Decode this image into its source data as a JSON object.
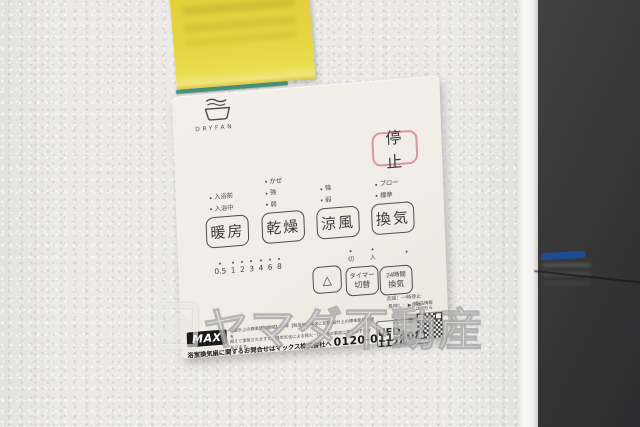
{
  "scene": {
    "watermark": {
      "text": "ヤマダ不動産"
    }
  },
  "colors": {
    "sticky_note_yellow": "#e7d33e",
    "note_strip_teal": "#3f9f85",
    "panel_bg": "#f1eee7",
    "stop_accent_pink": "#dd93a2",
    "button_line": "#4d4d50",
    "dark_door": "#353535",
    "door_sticker_blue": "#1c4f9c",
    "max_logo_bg": "#1a1a1a"
  },
  "panel": {
    "brand": {
      "name": "DRYFAN"
    },
    "stop_button": {
      "label": "停止"
    },
    "modes": [
      {
        "label": "暖房",
        "indicators": [
          "入浴前",
          "入浴中"
        ]
      },
      {
        "label": "乾燥",
        "indicators": [
          "かぜ",
          "強",
          "弱"
        ]
      },
      {
        "label": "涼風",
        "indicators": [
          "強",
          "弱"
        ]
      },
      {
        "label": "換気",
        "indicators": [
          "ブロー",
          "標準"
        ]
      }
    ],
    "timer_scale": {
      "values": [
        "0.5",
        "1",
        "2",
        "3",
        "4",
        "6",
        "8"
      ]
    },
    "select_button": {
      "label": "△"
    },
    "timer_toggle": {
      "line1": "タイマー",
      "line2": "切替",
      "off_label": "切",
      "on_label": "入"
    },
    "vent24": {
      "line1": "24時間",
      "line2": "換気"
    },
    "hints": {
      "line1": "点滅：一時停止",
      "line2": "長押し：▶停止"
    },
    "footer": {
      "max_logo": "MAX",
      "fine_print_line1": "【設計上の標準使用期間】10年【製造年】本体に記載 設計上の標準使用期間を",
      "fine_print_line2": "超えて使用されますと、経年劣化による発火・けが等の事故に至るおそれがあります。",
      "contact": "浴室換気扇に関するお問合せはマックス株式会社へ",
      "phone": "0120-011-408",
      "part_label": "品 番",
      "part_number": "UFD-112A",
      "qr_caption1": "製品情報",
      "qr_caption2": "はこちら"
    }
  }
}
